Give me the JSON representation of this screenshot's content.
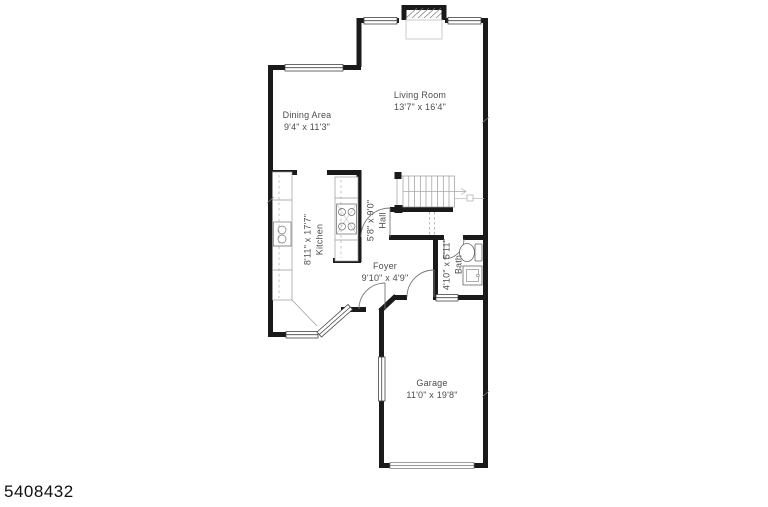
{
  "image": {
    "type": "residential floor plan",
    "watermark_id": "5408432"
  },
  "palette": {
    "background": "#ffffff",
    "walls": "#1a1a1a",
    "fixture_lines": "#777777",
    "label_text": "#4d4d4d",
    "watermark_text": "#111111"
  },
  "rooms": [
    {
      "name": "Living Room",
      "dims": "13'7\" x 16'4\"",
      "orientation": "horizontal"
    },
    {
      "name": "Dining Area",
      "dims": "9'4\" x 11'3\"",
      "orientation": "horizontal"
    },
    {
      "name": "Kitchen",
      "dims": "8'11\" x 17'7\"",
      "orientation": "vertical"
    },
    {
      "name": "Hall",
      "dims": "5'8\" x 9'0\"",
      "orientation": "vertical"
    },
    {
      "name": "Foyer",
      "dims": "9'10\" x 4'9\"",
      "orientation": "horizontal"
    },
    {
      "name": "Bath",
      "dims": "4'10\" x 5'11\"",
      "orientation": "vertical"
    },
    {
      "name": "Garage",
      "dims": "11'0\" x 19'8\"",
      "orientation": "horizontal"
    }
  ],
  "fixtures": [
    "fireplace",
    "staircase",
    "range-stove",
    "kitchen-sink",
    "toilet",
    "bath-sink",
    "garage-door",
    "windows",
    "doors"
  ]
}
